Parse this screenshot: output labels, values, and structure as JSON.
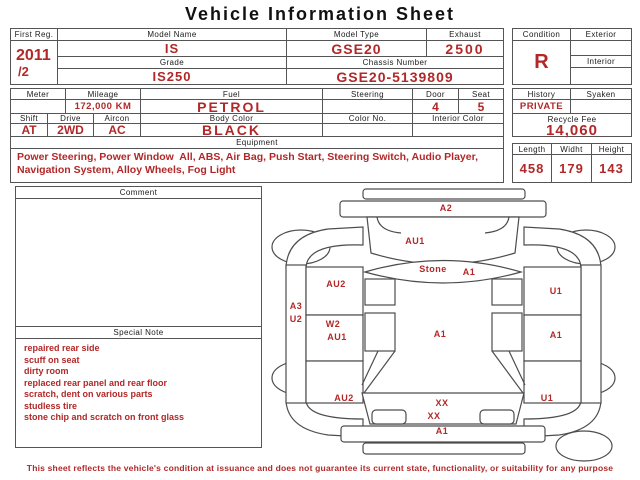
{
  "title": "Vehicle Information Sheet",
  "colors": {
    "accent_red": "#b22828",
    "border": "#555555"
  },
  "header_table": {
    "first_reg_label": "First Reg.",
    "first_reg_year": "2011",
    "first_reg_month": "/2",
    "model_name_label": "Model Name",
    "model_name": "IS",
    "grade_label": "Grade",
    "grade": "IS250",
    "model_type_label": "Model Type",
    "model_type": "GSE20",
    "exhaust_label": "Exhaust",
    "exhaust": "2500",
    "chassis_label": "Chassis Number",
    "chassis_number": "GSE20-5139809",
    "condition_label": "Condition",
    "condition": "R",
    "exterior_label": "Exterior",
    "exterior": "",
    "interior_label": "Interior",
    "interior": ""
  },
  "spec_table": {
    "meter_label": "Meter",
    "meter": "",
    "mileage_label": "Mileage",
    "mileage": "172,000 KM",
    "fuel_label": "Fuel",
    "fuel": "PETROL",
    "steering_label": "Steering",
    "steering": "",
    "door_label": "Door",
    "door": "4",
    "seat_label": "Seat",
    "seat": "5",
    "shift_label": "Shift",
    "shift": "AT",
    "drive_label": "Drive",
    "drive": "2WD",
    "aircon_label": "Aircon",
    "aircon": "AC",
    "body_color_label": "Body Color",
    "body_color": "BLACK",
    "color_no_label": "Color No.",
    "color_no": "",
    "interior_color_label": "Interior Color",
    "interior_color": "",
    "history_label": "History",
    "history": "PRIVATE",
    "syaken_label": "Syaken",
    "syaken": "",
    "recycle_fee_label": "Recycle Fee",
    "recycle_fee": "14,060"
  },
  "equipment": {
    "label": "Equipment",
    "text": "Power Steering, Power Window  All, ABS, Air Bag, Push Start, Steering Switch, Audio Player, Navigation System, Alloy Wheels, Fog Light"
  },
  "dimensions": {
    "length_label": "Length",
    "length": "458",
    "width_label": "Widht",
    "width": "179",
    "height_label": "Height",
    "height": "143"
  },
  "comment": {
    "label": "Comment",
    "text": ""
  },
  "special_note": {
    "label": "Special Note",
    "lines": [
      "repaired rear side",
      "scuff on seat",
      "dirty room",
      "replaced rear panel and rear floor",
      "scratch, dent on various parts",
      "studless tire",
      "stone chip and scratch on front glass"
    ]
  },
  "diagram": {
    "labels": [
      {
        "text": "A2",
        "x": 178,
        "y": 24
      },
      {
        "text": "AU1",
        "x": 147,
        "y": 57
      },
      {
        "text": "Stone",
        "x": 165,
        "y": 85
      },
      {
        "text": "A1",
        "x": 201,
        "y": 88
      },
      {
        "text": "AU2",
        "x": 68,
        "y": 100
      },
      {
        "text": "A3",
        "x": 28,
        "y": 122
      },
      {
        "text": "U2",
        "x": 28,
        "y": 135
      },
      {
        "text": "W2",
        "x": 65,
        "y": 140
      },
      {
        "text": "AU1",
        "x": 69,
        "y": 153
      },
      {
        "text": "A1",
        "x": 172,
        "y": 150
      },
      {
        "text": "U1",
        "x": 288,
        "y": 107
      },
      {
        "text": "A1",
        "x": 288,
        "y": 151
      },
      {
        "text": "AU2",
        "x": 76,
        "y": 214
      },
      {
        "text": "U1",
        "x": 279,
        "y": 214
      },
      {
        "text": "XX",
        "x": 174,
        "y": 219
      },
      {
        "text": "XX",
        "x": 166,
        "y": 232
      },
      {
        "text": "A1",
        "x": 174,
        "y": 247
      }
    ]
  },
  "footer": "This sheet reflects the vehicle's condition at issuance and does not guarantee its current state, functionality, or suitability for any purpose"
}
